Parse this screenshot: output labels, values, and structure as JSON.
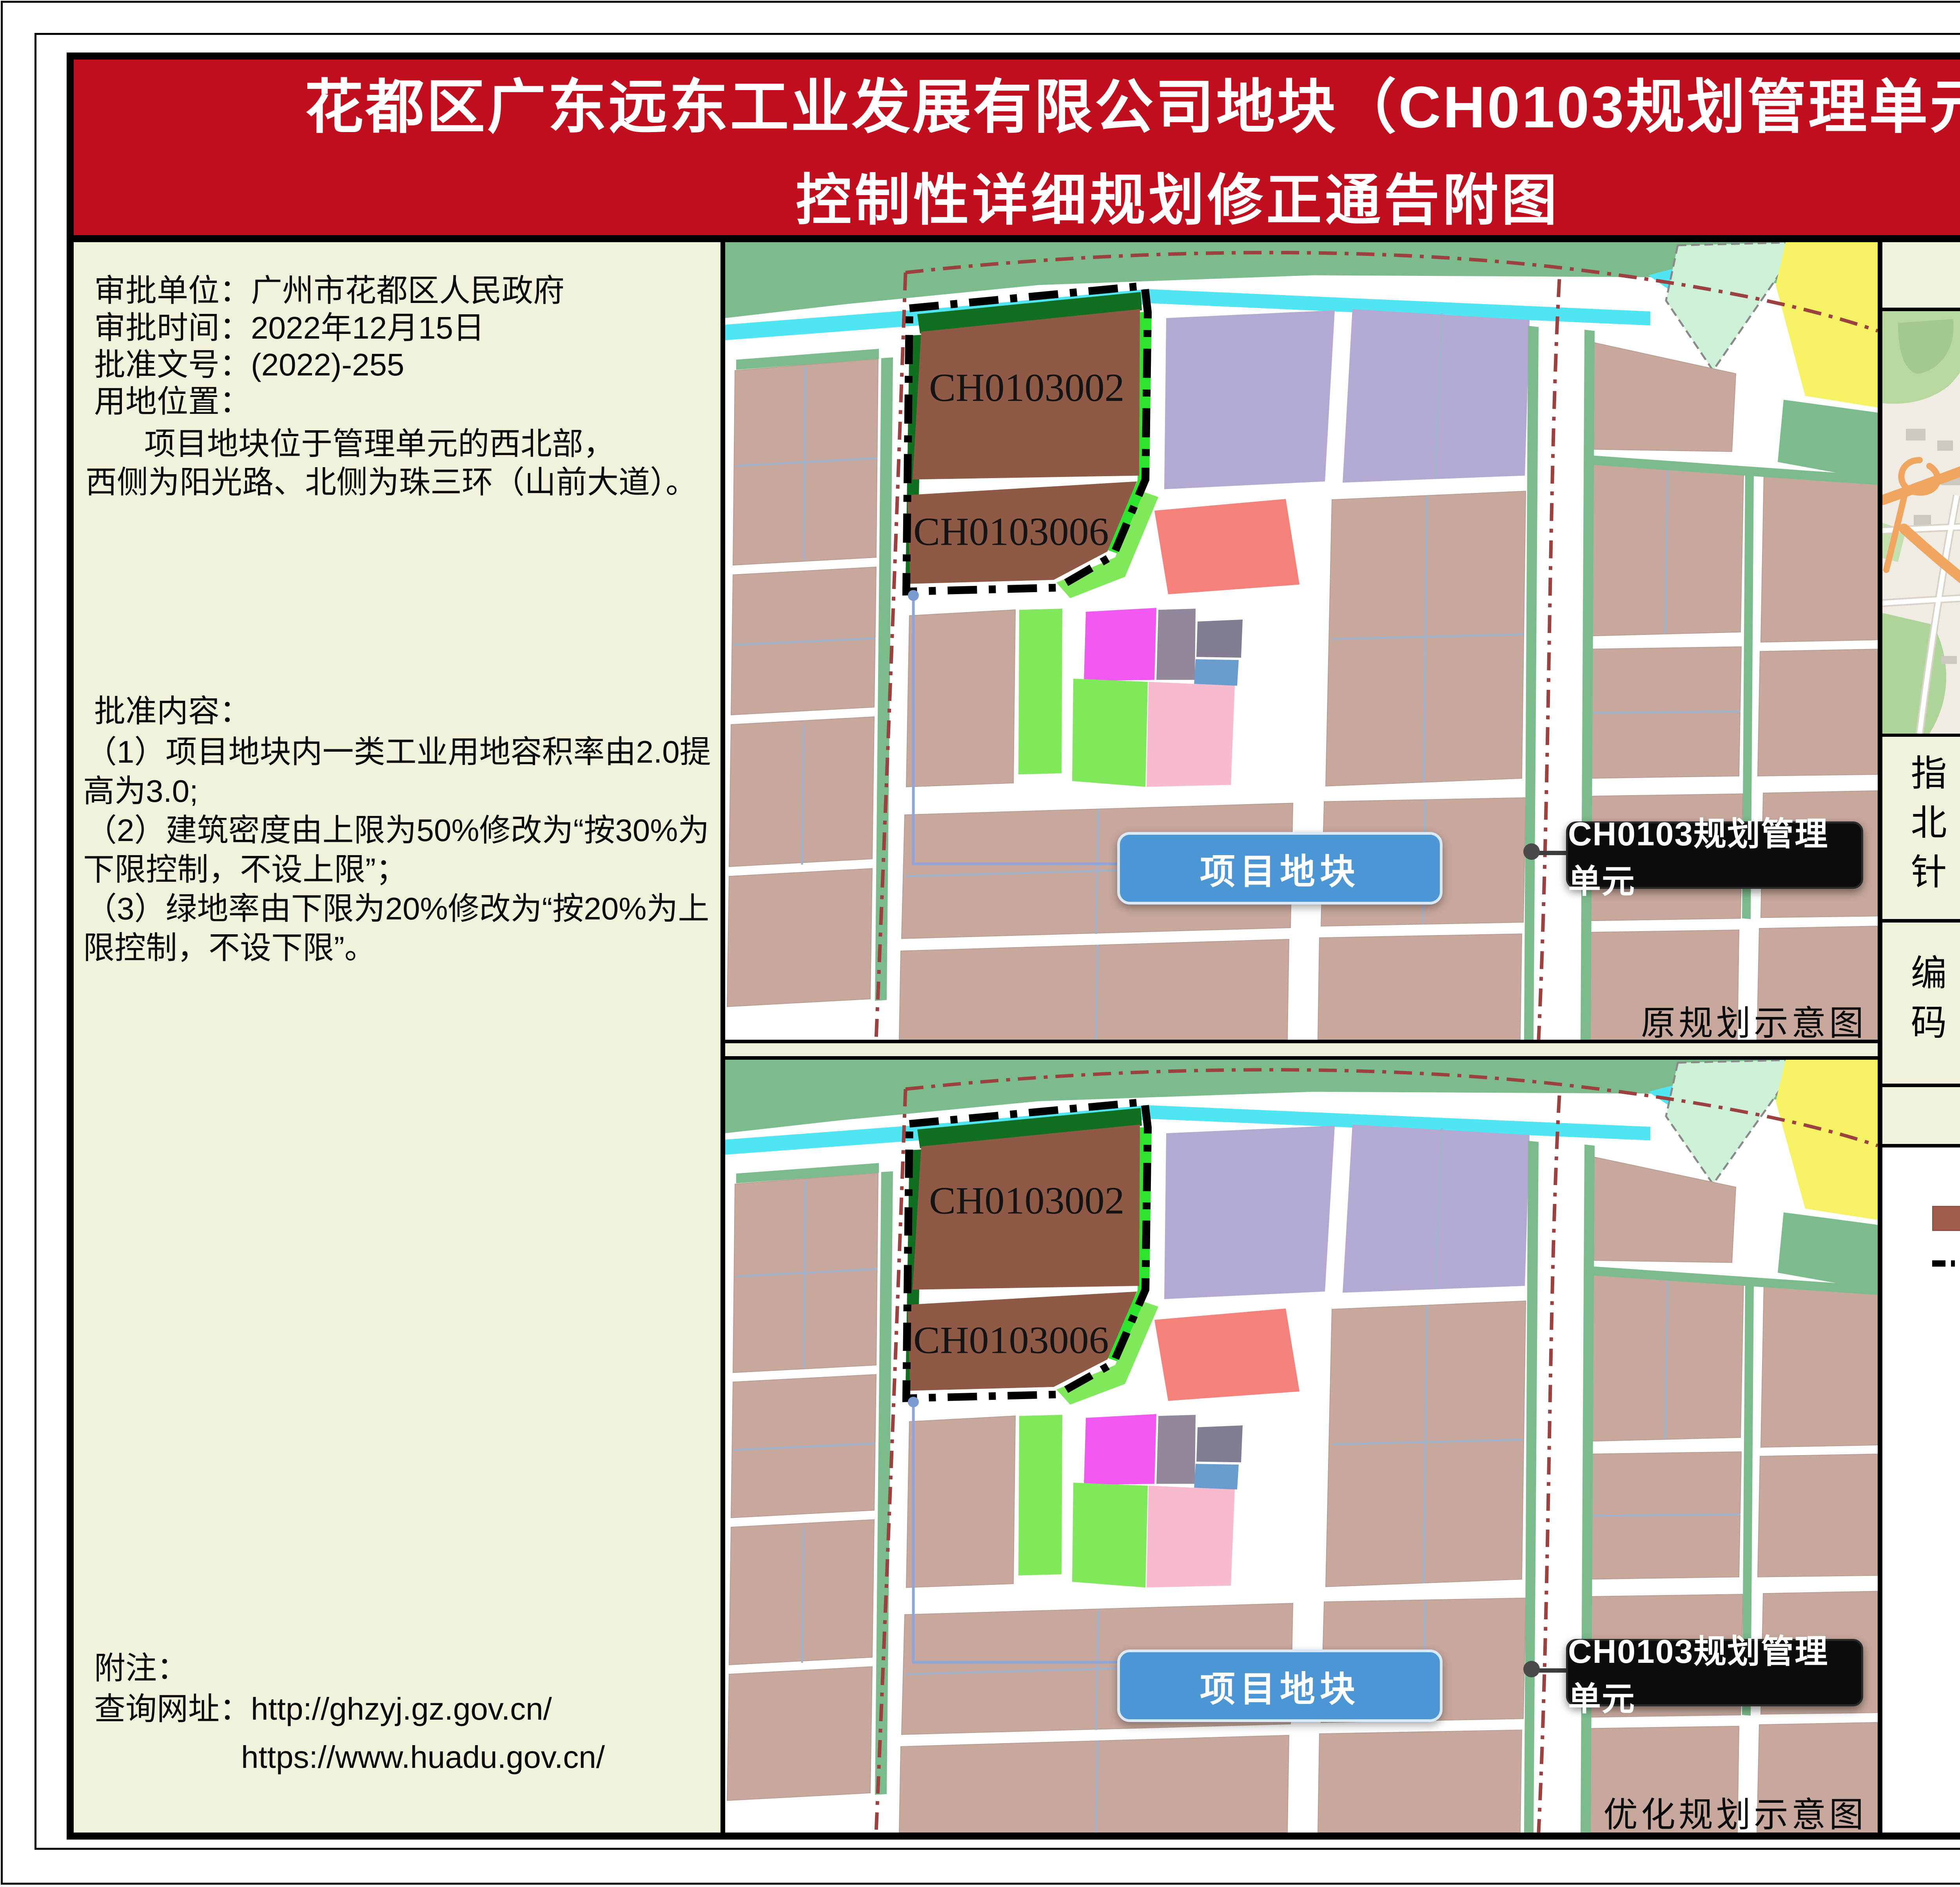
{
  "title": {
    "line1": "花都区广东远东工业发展有限公司地块（CH0103规划管理单元）",
    "line2": "控制性详细规划修正通告附图"
  },
  "left_panel": {
    "approval_unit": "审批单位：广州市花都区人民政府",
    "approval_time": "审批时间：2022年12月15日",
    "approval_number": "批准文号：(2022)-255",
    "location_label": "用地位置：",
    "location_line1": "项目地块位于管理单元的西北部，",
    "location_line2": "西侧为阳光路、北侧为珠三环（山前大道）。",
    "content_label": "批准内容：",
    "content_lines": [
      "（1）项目地块内一类工业用地容积率由2.0提",
      "高为3.0;",
      "（2）建筑密度由上限为50%修改为“按30%为",
      "下限控制，不设上限”；",
      "（3）绿地率由下限为20%修改为“按20%为上",
      "限控制，不设下限”。"
    ],
    "note_label": "附注：",
    "note_url1": "查询网址：http://ghzyj.gz.gov.cn/",
    "note_url2": "https://www.huadu.gov.cn/"
  },
  "maps": {
    "parcel1": "CH0103002",
    "parcel2": "CH0103006",
    "project_button": "项目地块",
    "unit_label": "CH0103规划管理单元",
    "caption_original": "原规划示意图",
    "caption_optimized": "优化规划示意图"
  },
  "right_panel": {
    "location_map_title": "区位图",
    "minimap": {
      "road_zhusanhuan": "珠三环",
      "road_jinshi": "金狮大道",
      "project_location": "项目位置",
      "reservoir": "秀全水库",
      "highway_guangqing": "广清高速"
    },
    "compass_label": "指北针",
    "compass_n": "N",
    "code_label": "编码",
    "code_value": "CH0103",
    "legend_title": "图　例",
    "legend_industrial": "工业用地",
    "legend_boundary": "项目地块范围"
  },
  "colors": {
    "title_bg": "#C10E1E",
    "panel_bg": "#F2F2DC",
    "industrial_brown": "#8E5A45",
    "legend_brown": "#A15B4D",
    "parcel_tan": "#C8A89D",
    "parcel_purple": "#B4A9D2",
    "parcel_salmon": "#F5817B",
    "parcel_magenta": "#F058F0",
    "parcel_pink": "#F8BACD",
    "parcel_green": "#7FE95B",
    "verge_green": "#7CBB8C",
    "water_cyan": "#4FE5F2",
    "button_blue": "#4D96D6",
    "unit_label_bg": "#0D0D0D",
    "boundary_red": "#9C4040",
    "minimap_highway_orange": "#F0A65E",
    "minimap_boundary_blue": "#2E2EF0",
    "project_dot_red": "#E80000"
  }
}
